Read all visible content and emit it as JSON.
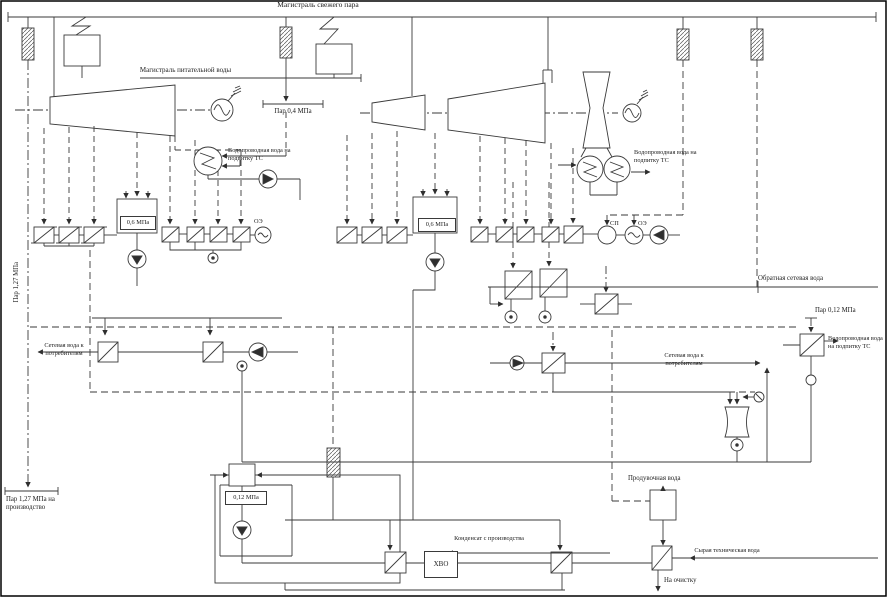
{
  "diagram": {
    "labels": {
      "fresh_steam_main": "Магистраль свежего пара",
      "feed_water_main": "Магистраль питательной воды",
      "steam_0_4_mpa": "Пар 0,4 МПа",
      "steam_1_27_mpa": "Пар 1,27 МПа",
      "steam_1_27_mpa_production": "Пар 1,27 МПа на производство",
      "steam_0_12_mpa": "Пар 0,12 МПа",
      "tap_water_makeup_1": "Водопроводная вода на подпитку ТС",
      "tap_water_makeup_2": "Водопроводная вода на подпитку ТС",
      "tap_water_makeup_3": "Водопроводная вода на подпитку ТС",
      "return_network_water": "Обратная сетевая вода",
      "network_water_to_consumers_1": "Сетевая вода к потребителям",
      "network_water_to_consumers_2": "Сетевая вода к потребителям",
      "blowdown_water": "Продувочная вода",
      "condensate_from_production": "Конденсат с производства",
      "raw_technical_water": "Сырая техническая вода",
      "to_treatment": "На очистку"
    },
    "equipment": {
      "deaerator_1_pressure": "0,6 МПа",
      "deaerator_2_pressure": "0,6 МПа",
      "deaerator_atmospheric_pressure": "0,12 МПа",
      "main_ejector_1": "ОЭ",
      "network_heater": "СП",
      "main_ejector_2": "ОЭ",
      "water_treatment": "ХВО"
    }
  }
}
